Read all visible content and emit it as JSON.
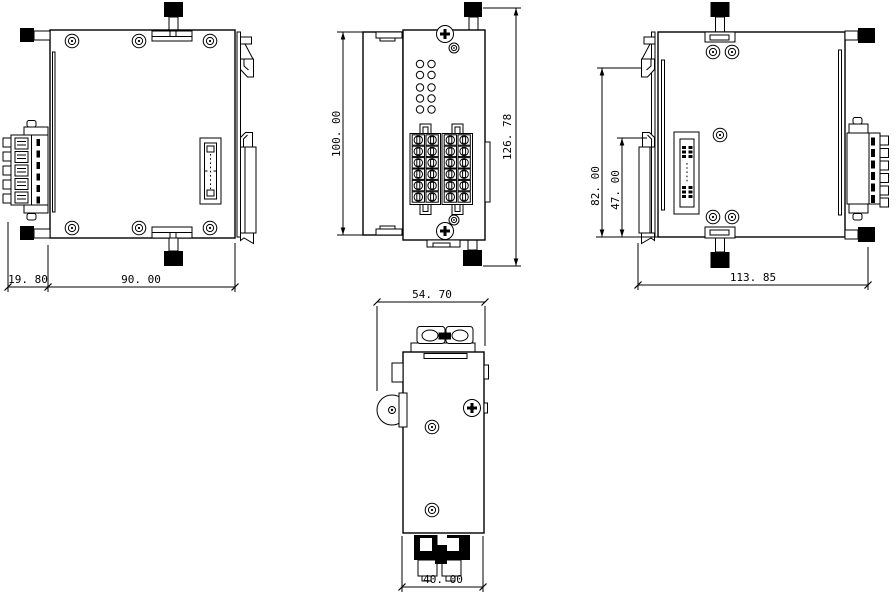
{
  "style": {
    "background": "#ffffff",
    "line_color": "#000000",
    "knob_color": "#000000"
  },
  "views": {
    "left_side": {
      "dimensions": {
        "connector_width": "19. 80",
        "body_width": "90. 00"
      }
    },
    "front": {
      "dimensions": {
        "body_height": "100. 00",
        "overall_height": "126. 78"
      }
    },
    "right_side": {
      "dimensions": {
        "clip_height": "82. 00",
        "lower_height": "47. 00",
        "overall_width": "113. 85"
      }
    },
    "bottom": {
      "dimensions": {
        "overall_width": "54. 70",
        "body_width": "40. 00"
      }
    }
  }
}
